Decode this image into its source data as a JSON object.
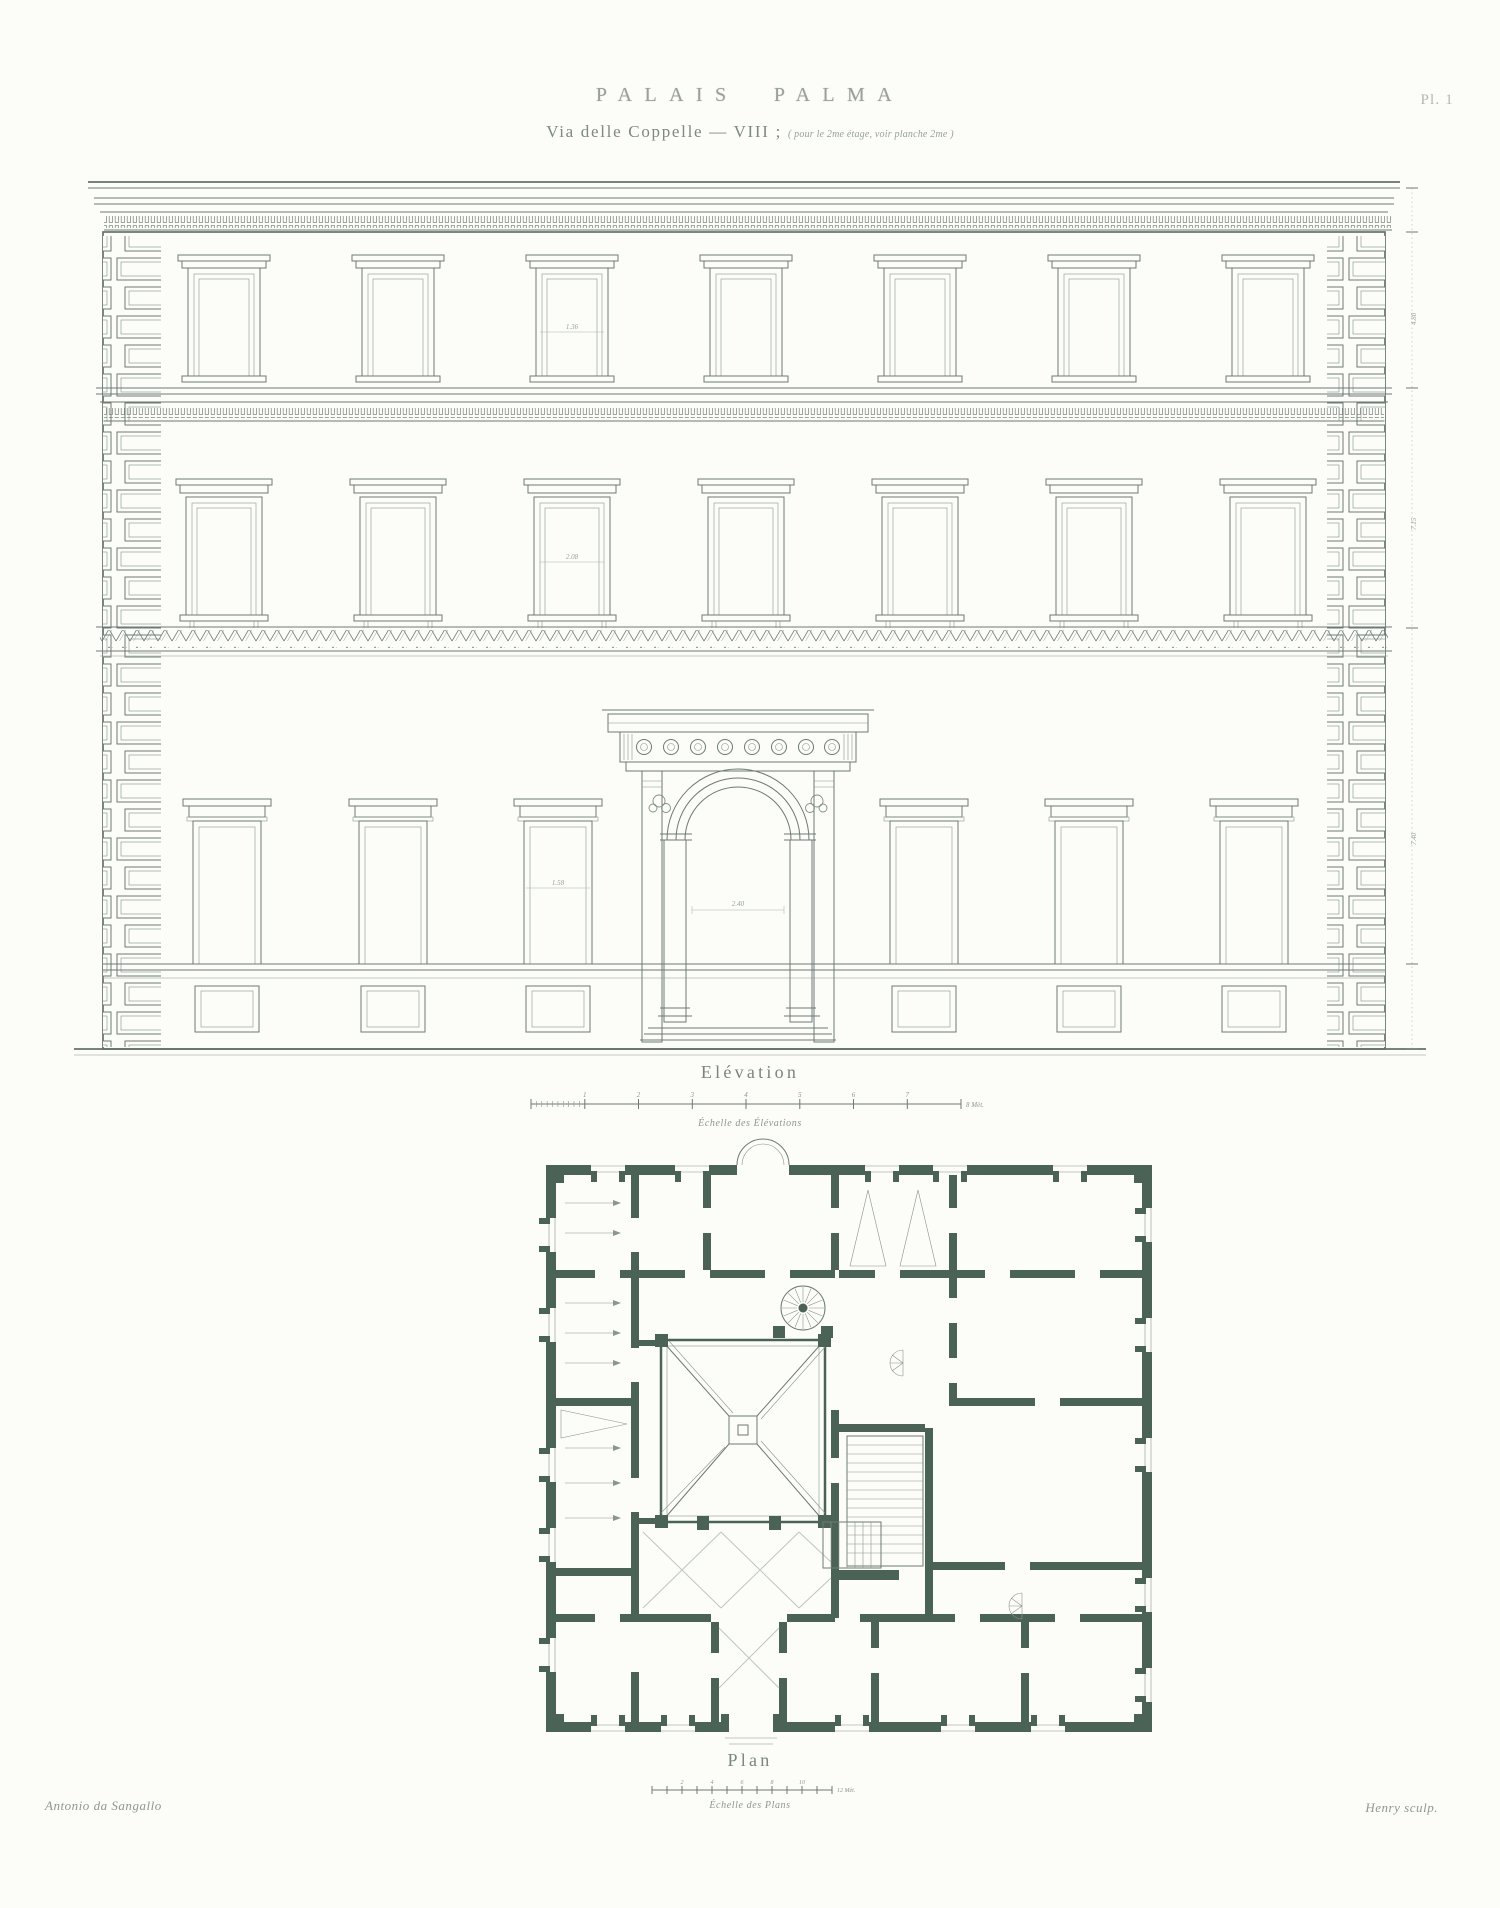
{
  "plate": {
    "title": "PALAIS PALMA",
    "subtitle": "Via delle Coppelle — VIII ;",
    "subtitle_note": "( pour le 2me étage, voir planche 2me )",
    "plate_number": "Pl. 1",
    "credit_left": "Antonio da Sangallo",
    "credit_right": "Henry sculp."
  },
  "elevation": {
    "label": "Elévation",
    "scale_caption": "Échelle des Élévations",
    "scale_ticks": [
      "1",
      "2",
      "3",
      "4",
      "5",
      "6",
      "7"
    ],
    "scale_end": "8 Mèt.",
    "dims": {
      "third": "1.36",
      "second": "2.08",
      "ground": "1.58",
      "portal": "2.40"
    },
    "side_dims": [
      "4.80",
      "7.15",
      "7.40"
    ]
  },
  "plan": {
    "label": "Plan",
    "scale_caption": "Échelle des Plans",
    "scale_ticks": [
      "2",
      "4",
      "6",
      "8",
      "10"
    ],
    "scale_end": "12 Mèt."
  },
  "colors": {
    "paper": "#fcfcf9",
    "ink": "#6e7a74",
    "plan_wall": "#4b6356"
  }
}
